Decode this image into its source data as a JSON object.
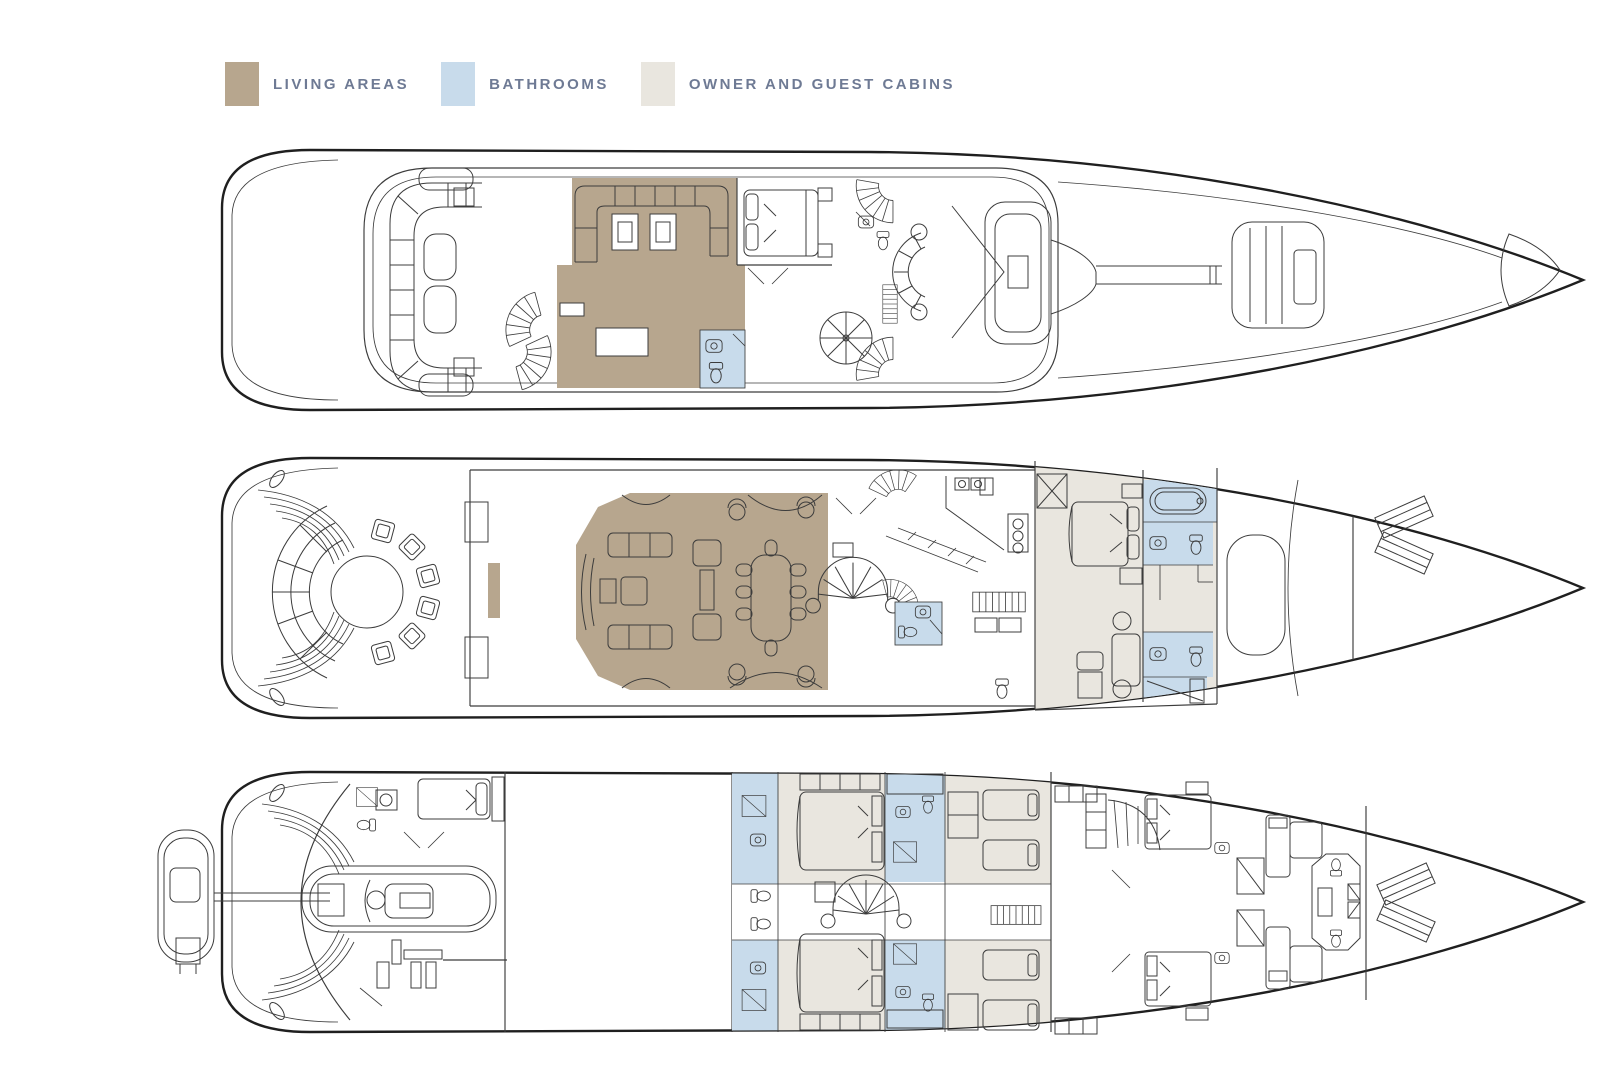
{
  "legend": {
    "items": [
      {
        "id": "living-areas",
        "label": "LIVING AREAS",
        "color": "#b7a68e"
      },
      {
        "id": "bathrooms",
        "label": "BATHROOMS",
        "color": "#c8dbeb"
      },
      {
        "id": "owner-guest-cabins",
        "label": "OWNER AND GUEST CABINS",
        "color": "#e9e6df"
      }
    ]
  },
  "colors": {
    "living_areas": "#b7a68e",
    "bathrooms": "#c8dbeb",
    "owner_guest_cabins": "#e9e6df",
    "legend_text": "#6e7a94",
    "outline": "#3c3c3c",
    "hull": "#1f1f1f",
    "background": "#ffffff"
  }
}
